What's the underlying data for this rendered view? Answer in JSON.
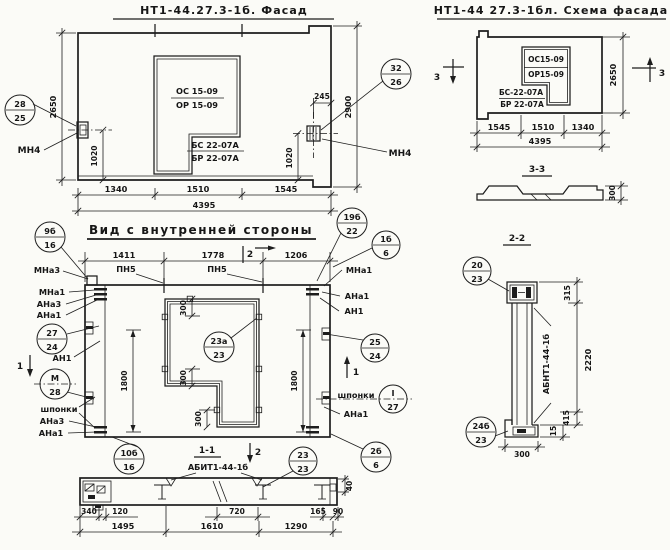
{
  "facade": {
    "title": "НТ1-44.27.3-1б. Фасад",
    "window": {
      "line1": "ОС 15-09",
      "line2": "ОР 15-09",
      "line3": "БС 22-07А",
      "line4": "БР 22-07А"
    },
    "callout_left": {
      "top": "28",
      "bottom": "25"
    },
    "callout_right": {
      "top": "32",
      "bottom": "26"
    },
    "anchor_left": "МН4",
    "anchor_right": "МН4",
    "dims": {
      "w1": "1340",
      "w2": "1510",
      "w3": "1545",
      "total": "4395",
      "h_left": "2650",
      "h_right": "2900",
      "edge": "245",
      "v_left": "1020",
      "v_right": "1020"
    }
  },
  "scheme": {
    "title": "НТ1-44 27.3-1бл. Схема фасада",
    "window": {
      "line1": "ОС15-09",
      "line2": "ОР15-09",
      "line3": "БС-22-07А",
      "line4": "БР 22-07А"
    },
    "marker": "3",
    "dims": {
      "w1": "1545",
      "w2": "1510",
      "w3": "1340",
      "total": "4395",
      "h_right": "2650"
    }
  },
  "section33": {
    "title": "3-3",
    "dim": "300"
  },
  "inner": {
    "title": "Вид с внутренней стороны",
    "labels": {
      "pn5a": "ПН5",
      "pn5b": "ПН5",
      "mna3": "МНа3",
      "mna1_l": "МНа1",
      "ana3_l": "АНа3",
      "ana1_l": "АНа1",
      "an1_l": "АН1",
      "shponki_l": "шпонки",
      "ana3_lb": "АНа3",
      "ana1_lb": "АНа1",
      "mna1_r": "МНа1",
      "ana1_r": "АНа1",
      "an1_r": "АН1",
      "shponki_r": "шпонки",
      "ana1_rb": "АНа1"
    },
    "callouts": {
      "c9b16": {
        "top": "9б",
        "bottom": "16"
      },
      "c19b22": {
        "top": "19б",
        "bottom": "22"
      },
      "c1b6": {
        "top": "1б",
        "bottom": "6"
      },
      "c2724": {
        "top": "27",
        "bottom": "24"
      },
      "cM28": {
        "top": "М",
        "bottom": "28"
      },
      "c10b16": {
        "top": "10б",
        "bottom": "16"
      },
      "c2524": {
        "top": "25",
        "bottom": "24"
      },
      "cI27": {
        "top": "I",
        "bottom": "27"
      },
      "c2b6": {
        "top": "2б",
        "bottom": "6"
      },
      "c23a23": {
        "top": "23а",
        "bottom": "23"
      }
    },
    "markers": {
      "m1": "1",
      "m2": "2"
    },
    "dims": {
      "w1": "1411",
      "w2": "1778",
      "w3": "1206",
      "h_left": "1800",
      "h_right": "1800",
      "win1": "300",
      "win2": "300",
      "win3": "300"
    }
  },
  "section11": {
    "title": "1-1",
    "label": "АБИТ1-44-1б",
    "marker": "2",
    "callout": {
      "top": "23",
      "bottom": "23"
    },
    "dims": {
      "d340": "340",
      "d120": "120",
      "d720": "720",
      "d165": "165",
      "d90": "90",
      "d40": "40",
      "b1": "1495",
      "b2": "1610",
      "b3": "1290"
    }
  },
  "section22": {
    "title": "2-2",
    "label": "АБНТ1-44-1б",
    "callout_top": {
      "top": "20",
      "bottom": "23"
    },
    "callout_bottom": {
      "top": "24б",
      "bottom": "23"
    },
    "dims": {
      "d315": "315",
      "d2220": "2220",
      "d415": "415",
      "d15": "15",
      "d300": "300"
    }
  }
}
